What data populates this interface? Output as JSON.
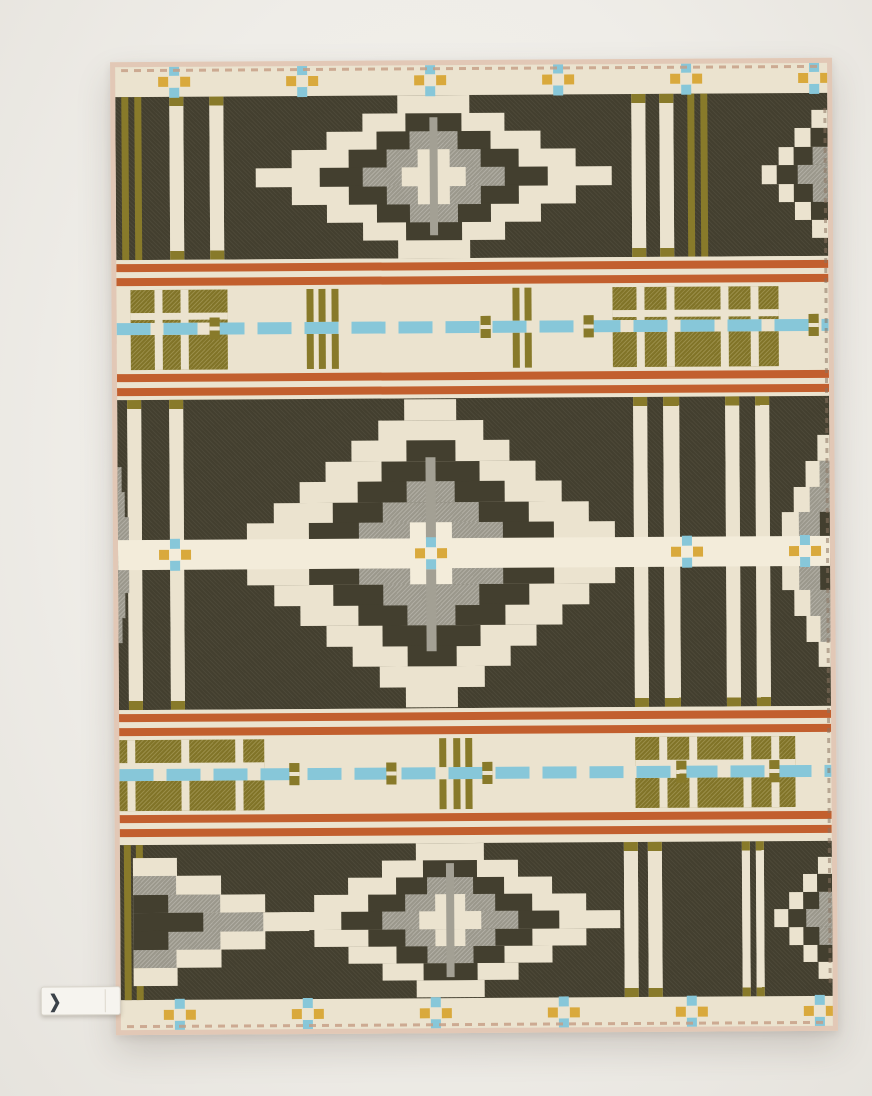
{
  "meta": {
    "description": "Product photograph of a folded-flat woven wool jacquard blanket with a geometric trade-blanket pattern: dark olive fields with stepped diamond and mesa motifs in cream and heather gray, plaid bands with rust-orange double stripes, olive green plaid blocks, a sky-blue dashed line, and small blue-and-gold cross motifs along cream borders.",
    "objects": [
      "wool blanket",
      "fabric brand tag"
    ]
  },
  "palette": {
    "bg": "#f1efea",
    "crm": "#ebe3cf",
    "crm2": "#f3ecda",
    "dark": "#433f2f",
    "olive": "#887a2a",
    "orange": "#c25f2e",
    "blue": "#87c7d9",
    "gold": "#d9a93c",
    "gray": "#a3a094",
    "gray2": "#8f8c80",
    "bind": "#e2c8b6",
    "stitch": "#c59c83",
    "tagbg": "#f6f4ef"
  },
  "blanket": {
    "position": {
      "left": 113,
      "top": 60,
      "width": 722,
      "height": 973,
      "rotate": -0.35
    },
    "rects": [
      [
        0,
        0,
        712,
        30,
        "crm",
        ""
      ],
      [
        0,
        933,
        712,
        30,
        "crm",
        ""
      ],
      [
        0,
        30,
        712,
        163,
        "dark",
        "tex"
      ],
      [
        6,
        30,
        7,
        163,
        "olive",
        ""
      ],
      [
        19,
        30,
        7,
        163,
        "olive",
        ""
      ],
      [
        54,
        30,
        14,
        163,
        "crm",
        "tip"
      ],
      [
        94,
        30,
        14,
        163,
        "crm",
        "tip"
      ],
      [
        516,
        30,
        14,
        163,
        "crm",
        "tip"
      ],
      [
        544,
        30,
        14,
        163,
        "crm",
        "tip"
      ],
      [
        572,
        30,
        7,
        163,
        "olive",
        ""
      ],
      [
        585,
        30,
        7,
        163,
        "olive",
        ""
      ],
      [
        0,
        193,
        712,
        140,
        "crm",
        ""
      ],
      [
        14,
        223,
        97,
        80,
        "olive",
        "gtex"
      ],
      [
        38,
        223,
        8,
        80,
        "crm",
        ""
      ],
      [
        64,
        223,
        8,
        80,
        "crm",
        ""
      ],
      [
        14,
        246,
        97,
        7,
        "crm",
        ""
      ],
      [
        190,
        223,
        7,
        80,
        "olive",
        ""
      ],
      [
        202,
        223,
        7,
        80,
        "olive",
        ""
      ],
      [
        215,
        223,
        7,
        80,
        "olive",
        ""
      ],
      [
        396,
        223,
        7,
        80,
        "olive",
        ""
      ],
      [
        408,
        223,
        7,
        80,
        "olive",
        ""
      ],
      [
        496,
        223,
        166,
        80,
        "olive",
        "gtex"
      ],
      [
        520,
        223,
        8,
        80,
        "crm",
        ""
      ],
      [
        550,
        223,
        8,
        80,
        "crm",
        ""
      ],
      [
        604,
        223,
        8,
        80,
        "crm",
        ""
      ],
      [
        634,
        223,
        8,
        80,
        "crm",
        ""
      ],
      [
        496,
        246,
        166,
        7,
        "crm",
        ""
      ],
      [
        0,
        197,
        712,
        8,
        "orange",
        ""
      ],
      [
        0,
        211,
        712,
        8,
        "orange",
        ""
      ],
      [
        0,
        307,
        712,
        8,
        "orange",
        ""
      ],
      [
        0,
        321,
        712,
        8,
        "orange",
        ""
      ],
      [
        0,
        333,
        712,
        310,
        "dark",
        "tex"
      ],
      [
        10,
        333,
        14,
        310,
        "crm",
        "tip"
      ],
      [
        52,
        333,
        14,
        310,
        "crm",
        "tip"
      ],
      [
        516,
        333,
        14,
        310,
        "crm",
        "tip"
      ],
      [
        546,
        333,
        16,
        310,
        "crm",
        "tip"
      ],
      [
        608,
        333,
        14,
        310,
        "crm",
        "tip"
      ],
      [
        638,
        333,
        14,
        310,
        "crm",
        "tip"
      ],
      [
        0,
        643,
        712,
        135,
        "crm",
        ""
      ],
      [
        0,
        673,
        145,
        71,
        "olive",
        "gtex"
      ],
      [
        8,
        673,
        8,
        71,
        "crm",
        ""
      ],
      [
        62,
        673,
        8,
        71,
        "crm",
        ""
      ],
      [
        116,
        673,
        8,
        71,
        "crm",
        ""
      ],
      [
        0,
        696,
        145,
        7,
        "crm",
        ""
      ],
      [
        320,
        673,
        7,
        71,
        "olive",
        ""
      ],
      [
        334,
        673,
        7,
        71,
        "olive",
        ""
      ],
      [
        346,
        673,
        7,
        71,
        "olive",
        ""
      ],
      [
        516,
        673,
        160,
        71,
        "olive",
        "gtex"
      ],
      [
        540,
        673,
        8,
        71,
        "crm",
        ""
      ],
      [
        570,
        673,
        8,
        71,
        "crm",
        ""
      ],
      [
        624,
        673,
        8,
        71,
        "crm",
        ""
      ],
      [
        652,
        673,
        8,
        71,
        "crm",
        ""
      ],
      [
        516,
        696,
        160,
        7,
        "crm",
        ""
      ],
      [
        0,
        647,
        712,
        8,
        "orange",
        ""
      ],
      [
        0,
        661,
        712,
        8,
        "orange",
        ""
      ],
      [
        0,
        748,
        712,
        8,
        "orange",
        ""
      ],
      [
        0,
        762,
        712,
        8,
        "orange",
        ""
      ],
      [
        0,
        778,
        712,
        155,
        "dark",
        "tex"
      ],
      [
        4,
        778,
        7,
        155,
        "olive",
        ""
      ],
      [
        16,
        778,
        7,
        155,
        "olive",
        ""
      ],
      [
        504,
        778,
        14,
        155,
        "crm",
        "tip"
      ],
      [
        528,
        778,
        14,
        155,
        "crm",
        "tip"
      ],
      [
        622,
        778,
        8,
        155,
        "crm",
        "tip"
      ],
      [
        636,
        778,
        8,
        155,
        "crm",
        "tip"
      ]
    ],
    "diamonds": [
      {
        "cx": 318,
        "cy": 111,
        "w": 356,
        "h": 162,
        "rows": 9,
        "layers": [
          [
            "crm",
            1
          ],
          [
            "dark",
            0.64
          ],
          [
            "gray",
            0.4
          ],
          [
            "crm",
            0.18
          ]
        ]
      },
      {
        "cx": 313,
        "cy": 488,
        "w": 420,
        "h": 308,
        "rows": 15,
        "layers": [
          [
            "crm",
            1
          ],
          [
            "dark",
            0.7
          ],
          [
            "gray",
            0.46
          ],
          [
            "crm2",
            0.2
          ]
        ]
      },
      {
        "cx": 330,
        "cy": 855,
        "w": 340,
        "h": 154,
        "rows": 9,
        "layers": [
          [
            "crm",
            1
          ],
          [
            "dark",
            0.64
          ],
          [
            "gray",
            0.4
          ],
          [
            "crm",
            0.18
          ]
        ]
      }
    ],
    "mesas": [
      {
        "side": "right",
        "inset": 0,
        "cy": 111,
        "h": 128,
        "depth": 66,
        "rows": 7,
        "layers": [
          [
            "crm",
            1
          ],
          [
            "dark",
            0.78
          ],
          [
            "gray",
            0.45
          ]
        ]
      },
      {
        "side": "left",
        "inset": 0,
        "cy": 488,
        "h": 176,
        "depth": 14,
        "rows": 7,
        "layers": [
          [
            "gray",
            1
          ]
        ]
      },
      {
        "side": "right",
        "inset": 0,
        "cy": 488,
        "h": 232,
        "depth": 60,
        "rows": 9,
        "layers": [
          [
            "crm",
            1
          ],
          [
            "gray",
            0.68
          ],
          [
            "dark",
            0.32
          ]
        ]
      },
      {
        "side": "left",
        "inset": 13,
        "cy": 855,
        "h": 128,
        "depth": 176,
        "rows": 7,
        "layers": [
          [
            "crm",
            1
          ],
          [
            "gray",
            0.74
          ],
          [
            "dark",
            0.4
          ]
        ]
      },
      {
        "side": "right",
        "inset": 0,
        "cy": 855,
        "h": 122,
        "depth": 58,
        "rows": 7,
        "layers": [
          [
            "crm",
            1
          ],
          [
            "dark",
            0.76
          ],
          [
            "gray",
            0.44
          ]
        ]
      }
    ],
    "center_columns": [
      [
        314,
        52,
        8,
        118,
        "gray"
      ],
      [
        308,
        392,
        10,
        82,
        "gray"
      ],
      [
        308,
        504,
        10,
        82,
        "gray"
      ],
      [
        326,
        798,
        8,
        114,
        "gray"
      ]
    ],
    "center_stripe": [
      0,
      473,
      712,
      30,
      "crm2"
    ],
    "blue_lines": [
      {
        "x": 0,
        "y": 256,
        "w": 712,
        "h": 12,
        "beads": [
          93,
          364,
          467,
          692
        ]
      },
      {
        "x": 0,
        "y": 702,
        "w": 712,
        "h": 12,
        "beads": [
          170,
          267,
          363,
          557,
          650
        ]
      }
    ],
    "crosses": {
      "top_row_y": 15,
      "top_row_x": [
        59,
        187,
        315,
        443,
        571,
        699
      ],
      "middle_row_y": 488,
      "middle_row_x": [
        57,
        313,
        569,
        687
      ],
      "bottom_row_y": 948,
      "bottom_row_x": [
        59,
        187,
        315,
        443,
        571,
        699
      ]
    },
    "stitches": {
      "top": [
        6,
        2,
        700
      ],
      "bottom": [
        6,
        958,
        700
      ],
      "right": [
        708,
        40,
        880
      ]
    }
  },
  "tag": {
    "x": -80,
    "y": 919,
    "w": 78,
    "h": 27,
    "glyph": "❯"
  }
}
